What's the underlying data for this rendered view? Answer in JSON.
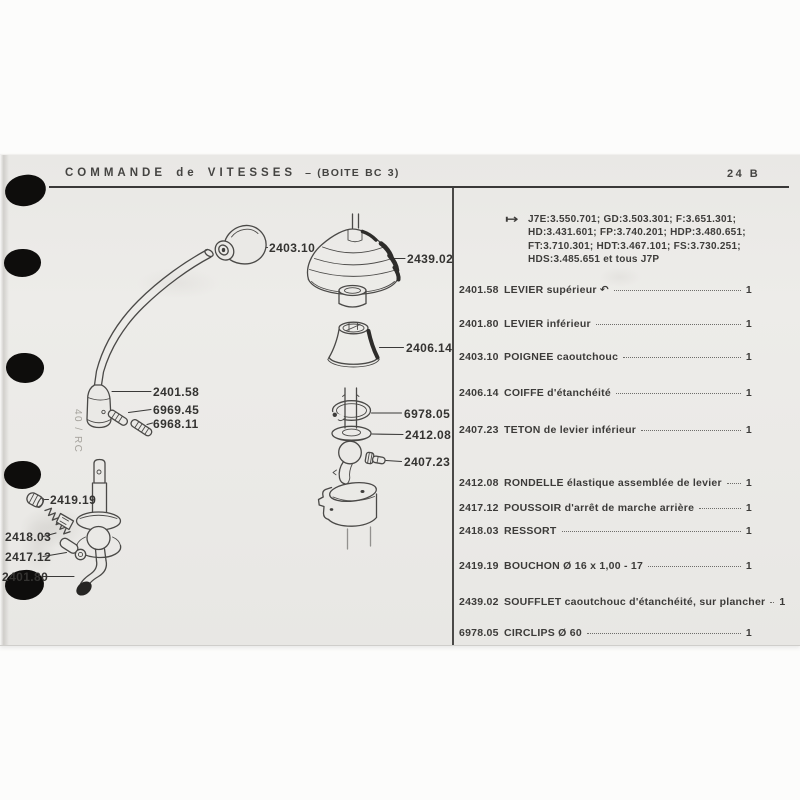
{
  "header": {
    "title": "COMMANDE de VITESSES",
    "subtitle": "– (BOITE BC 3)",
    "page_ref": "24 B"
  },
  "note": {
    "arrow": "↦",
    "lines": [
      "J7E:3.550.701;  GD:3.503.301;  F:3.651.301;",
      "HD:3.431.601;  FP:3.740.201;  HDP:3.480.651;",
      "FT:3.710.301;  HDT:3.467.101;  FS:3.730.251;",
      "HDS:3.485.651 et tous J7P"
    ]
  },
  "parts_list": {
    "rows": [
      {
        "ref": "2401.58",
        "desc": "LEVIER supérieur ↶",
        "qty": "1"
      },
      {
        "ref": "2401.80",
        "desc": "LEVIER inférieur",
        "qty": "1"
      },
      {
        "ref": "2403.10",
        "desc": "POIGNEE caoutchouc",
        "qty": "1"
      },
      {
        "ref": "2406.14",
        "desc": "COIFFE d'étanchéité",
        "qty": "1"
      },
      {
        "ref": "2407.23",
        "desc": "TETON de levier inférieur",
        "qty": "1"
      },
      {
        "ref": "2412.08",
        "desc": "RONDELLE élastique assemblée de levier",
        "qty": "1"
      },
      {
        "ref": "2417.12",
        "desc": "POUSSOIR d'arrêt de marche arrière",
        "qty": "1"
      },
      {
        "ref": "2418.03",
        "desc": "RESSORT",
        "qty": "1"
      },
      {
        "ref": "2419.19",
        "desc": "BOUCHON Ø 16 x 1,00 - 17",
        "qty": "1"
      },
      {
        "ref": "2439.02",
        "desc": "SOUFFLET caoutchouc d'étanchéité, sur plancher",
        "qty": "1"
      },
      {
        "ref": "6978.05",
        "desc": "CIRCLIPS Ø 60",
        "qty": "1"
      }
    ]
  },
  "diagram": {
    "labels": [
      "2403.10",
      "2439.02",
      "2406.14",
      "2401.58",
      "6969.45",
      "6968.11",
      "6978.05",
      "2412.08",
      "2407.23",
      "2419.19",
      "2418.03",
      "2417.12",
      "2401.80"
    ]
  },
  "scan": {
    "margin_note": "40 / RC"
  }
}
